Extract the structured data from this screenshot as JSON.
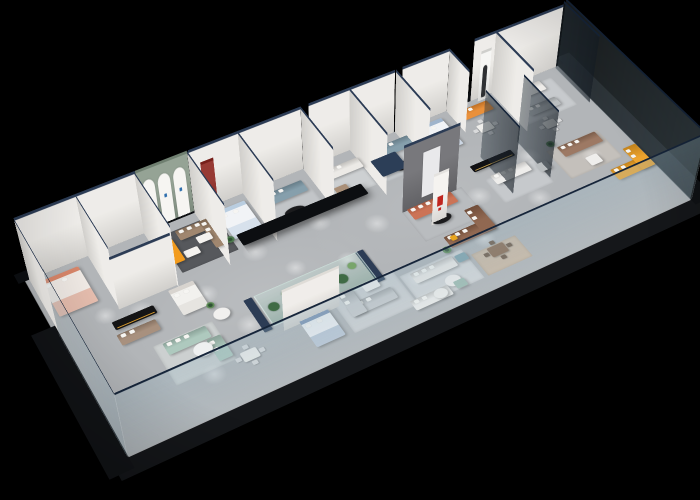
{
  "meta": {
    "background": "#000000"
  },
  "scene": {
    "wallH": 85,
    "glassH": 92,
    "wallColor": "#edebe7",
    "wallCap": "#2c3c55",
    "glassCap": "#16253a",
    "floor": {
      "w": 1150,
      "h": 440,
      "color": "#b2b5b8"
    },
    "aprons": [
      {
        "x": -20,
        "y": 440,
        "w": 1192,
        "h": 36,
        "c": "#15171a"
      },
      {
        "x": -36,
        "y": 128,
        "w": 44,
        "h": 336,
        "c": "#121417"
      },
      {
        "x": 1146,
        "y": -14,
        "w": 44,
        "h": 468,
        "c": "#101215"
      },
      {
        "x": -12,
        "y": -16,
        "w": 1174,
        "h": 24,
        "c": "#0d0f12"
      }
    ],
    "rugs": [
      {
        "x": 250,
        "y": 30,
        "w": 112,
        "h": 100,
        "c": "#56585c"
      },
      {
        "x": 438,
        "y": 32,
        "w": 112,
        "h": 100,
        "c": "#c2c5c8"
      },
      {
        "x": 128,
        "y": 40,
        "w": 100,
        "h": 85,
        "c": "#c7c9cb"
      },
      {
        "x": 664,
        "y": 198,
        "w": 130,
        "h": 85,
        "c": "#b9bcbf"
      },
      {
        "x": 448,
        "y": 310,
        "w": 128,
        "h": 92,
        "c": "#cfd1d3"
      },
      {
        "x": 580,
        "y": 330,
        "w": 130,
        "h": 78,
        "c": "#d4d6d8"
      },
      {
        "x": 718,
        "y": 350,
        "w": 95,
        "h": 58,
        "c": "#cbb9a5"
      },
      {
        "x": 985,
        "y": 200,
        "w": 120,
        "h": 85,
        "c": "#c4c0bb"
      },
      {
        "x": 842,
        "y": 205,
        "w": 110,
        "h": 70,
        "c": "#c6c9cc"
      },
      {
        "x": 135,
        "y": 255,
        "w": 112,
        "h": 95,
        "c": "#ccd0d0"
      },
      {
        "x": 680,
        "y": 30,
        "w": 104,
        "h": 88,
        "c": "#c3c7ca"
      },
      {
        "x": 568,
        "y": 36,
        "w": 92,
        "h": 78,
        "c": "#cdd0d2"
      },
      {
        "x": 996,
        "y": 30,
        "w": 118,
        "h": 92,
        "c": "#c7cacd"
      }
    ],
    "spots": [
      [
        150,
        175,
        24
      ],
      [
        265,
        195,
        22
      ],
      [
        385,
        150,
        24
      ],
      [
        520,
        145,
        22
      ],
      [
        610,
        200,
        24
      ],
      [
        700,
        175,
        22
      ],
      [
        810,
        235,
        24
      ],
      [
        950,
        195,
        22
      ],
      [
        300,
        295,
        24
      ],
      [
        455,
        300,
        22
      ],
      [
        610,
        350,
        24
      ],
      [
        760,
        330,
        22
      ],
      [
        905,
        295,
        24
      ],
      [
        1055,
        255,
        22
      ],
      [
        200,
        360,
        22
      ],
      [
        92,
        152,
        20
      ],
      [
        520,
        250,
        20
      ],
      [
        430,
        220,
        20
      ]
    ],
    "walls": [
      {
        "d": "x",
        "x": 8,
        "y": 8,
        "len": 224
      },
      {
        "d": "x",
        "x": 232,
        "y": 8,
        "len": 100,
        "c": "#8d9c8d",
        "cap": "#6f7f70",
        "arches": 3
      },
      {
        "d": "x",
        "x": 334,
        "y": 8,
        "len": 226
      },
      {
        "d": "x",
        "x": 576,
        "y": 8,
        "len": 184
      },
      {
        "d": "x",
        "x": 776,
        "y": 8,
        "len": 104
      },
      {
        "d": "x",
        "x": 936,
        "y": 8,
        "len": 206
      },
      {
        "d": "y",
        "x": 8,
        "y": 8,
        "len": 134
      },
      {
        "d": "y",
        "x": 120,
        "y": 8,
        "len": 140
      },
      {
        "d": "y",
        "x": 230,
        "y": 8,
        "len": 148
      },
      {
        "d": "y",
        "x": 332,
        "y": 8,
        "len": 148
      },
      {
        "d": "y",
        "x": 432,
        "y": 8,
        "len": 138
      },
      {
        "d": "y",
        "x": 560,
        "y": 8,
        "len": 122
      },
      {
        "d": "y",
        "x": 662,
        "y": 8,
        "len": 138
      },
      {
        "d": "y",
        "x": 762,
        "y": 8,
        "len": 122
      },
      {
        "d": "y",
        "x": 880,
        "y": 8,
        "len": 70
      },
      {
        "d": "y",
        "x": 985,
        "y": 8,
        "len": 128
      },
      {
        "d": "x",
        "x": 118,
        "y": 150,
        "len": 112,
        "h": 72
      },
      {
        "d": "x",
        "x": 664,
        "y": 200,
        "len": 118,
        "h": 92,
        "c": "#6e6e72",
        "panel": "#e9e9eb"
      },
      {
        "d": "x",
        "x": 345,
        "y": 336,
        "len": 110,
        "h": 56,
        "c": "#efece8",
        "cap": "#dfdcd7"
      },
      {
        "d": "x",
        "x": 352,
        "y": 14,
        "len": 26,
        "h": 66,
        "c": "#8f2b25",
        "cap": "#771f1a"
      },
      {
        "d": "x",
        "x": 948,
        "y": 16,
        "len": 24,
        "h": 68,
        "c": "#f5f5f3",
        "cap": "#cfcfcc",
        "figure": true
      },
      {
        "d": "x",
        "x": 694,
        "y": 254,
        "len": 32,
        "h": 70,
        "c": "#f4f2ef",
        "cap": "#e4e2df",
        "mark": "#c0251f"
      }
    ],
    "glass": [
      {
        "d": "y",
        "x": 6,
        "y": 150,
        "len": 288
      },
      {
        "d": "x",
        "x": 6,
        "y": 438,
        "len": 1142
      },
      {
        "d": "y",
        "x": 1146,
        "y": 8,
        "len": 430
      },
      {
        "d": "y",
        "x": 868,
        "y": 150,
        "len": 112,
        "tint": true
      },
      {
        "d": "y",
        "x": 952,
        "y": 150,
        "len": 112,
        "tint": true
      },
      {
        "d": "y",
        "x": 1138,
        "y": 12,
        "len": 118,
        "tint": true
      }
    ],
    "furniture": [
      {
        "type": "bed",
        "x": 20,
        "y": 34,
        "w": 72,
        "h": 92,
        "c": "#efe9e4",
        "accent": "#d8866a"
      },
      {
        "type": "bed",
        "x": 362,
        "y": 38,
        "w": 58,
        "h": 78,
        "c": "#f1f3f6",
        "accent": "#b9cde0"
      },
      {
        "type": "bed",
        "x": 790,
        "y": 32,
        "w": 62,
        "h": 82,
        "c": "#f1f3f6",
        "accent": "#9fb4cc"
      },
      {
        "type": "bed",
        "x": 206,
        "y": 166,
        "w": 48,
        "h": 64,
        "c": "#f2f1ee",
        "accent": "#d8d4cf"
      },
      {
        "type": "bed",
        "x": 372,
        "y": 340,
        "w": 56,
        "h": 66,
        "c": "#eef0f3",
        "accent": "#7e96b5"
      },
      {
        "type": "sofa",
        "x": 138,
        "y": 52,
        "w": 86,
        "h": 30,
        "c": "#d27a55",
        "p": 3
      },
      {
        "type": "sofa",
        "x": 276,
        "y": 44,
        "w": 74,
        "h": 26,
        "c": "#9a7f66",
        "p": 3
      },
      {
        "type": "sofa",
        "x": 324,
        "y": 44,
        "w": 26,
        "h": 74,
        "c": "#9a7f66",
        "p": 2
      },
      {
        "type": "sofa",
        "x": 448,
        "y": 44,
        "w": 88,
        "h": 30,
        "c": "#7e99a7",
        "p": 3
      },
      {
        "type": "sofa",
        "x": 572,
        "y": 44,
        "w": 84,
        "h": 28,
        "c": "#ebe9e5",
        "p": 3
      },
      {
        "type": "sofa",
        "x": 688,
        "y": 40,
        "w": 84,
        "h": 30,
        "c": "#7e99a7",
        "p": 3
      },
      {
        "type": "sofa",
        "x": 888,
        "y": 34,
        "w": 68,
        "h": 28,
        "c": "#e8892e",
        "p": 2
      },
      {
        "type": "sofa",
        "x": 1000,
        "y": 38,
        "w": 78,
        "h": 28,
        "c": "#edebe8",
        "p": 3
      },
      {
        "type": "sofa",
        "x": 1008,
        "y": 92,
        "w": 70,
        "h": 24,
        "c": "#b7bbbd",
        "p": 2
      },
      {
        "type": "sofa",
        "x": 88,
        "y": 212,
        "w": 72,
        "h": 26,
        "c": "#a38a76",
        "p": 2
      },
      {
        "type": "sofa",
        "x": 148,
        "y": 268,
        "w": 80,
        "h": 28,
        "c": "#a9c6ba",
        "p": 3
      },
      {
        "type": "sofa",
        "x": 216,
        "y": 298,
        "w": 26,
        "h": 52,
        "c": "#a9c6ba",
        "p": 2
      },
      {
        "type": "sofa",
        "x": 668,
        "y": 208,
        "w": 94,
        "h": 30,
        "c": "#c96a4b",
        "p": 3
      },
      {
        "type": "sofa",
        "x": 848,
        "y": 212,
        "w": 78,
        "h": 26,
        "c": "#edecea",
        "p": 3
      },
      {
        "type": "sofa",
        "x": 1000,
        "y": 212,
        "w": 88,
        "h": 30,
        "c": "#97715a",
        "p": 3
      },
      {
        "type": "sofa",
        "x": 1052,
        "y": 312,
        "w": 84,
        "h": 30,
        "c": "#f0a122",
        "p": 2
      },
      {
        "type": "sofa",
        "x": 1106,
        "y": 278,
        "w": 30,
        "h": 64,
        "c": "#f0a122",
        "p": 2
      },
      {
        "type": "sofa",
        "x": 458,
        "y": 352,
        "w": 90,
        "h": 28,
        "c": "#c7c9cb",
        "p": 3
      },
      {
        "type": "sofa",
        "x": 458,
        "y": 320,
        "w": 28,
        "h": 60,
        "c": "#c7c9cb",
        "p": 2
      },
      {
        "type": "sofa",
        "x": 592,
        "y": 344,
        "w": 86,
        "h": 26,
        "c": "#ebe9e6",
        "p": 3
      },
      {
        "type": "sofa",
        "x": 690,
        "y": 300,
        "w": 96,
        "h": 30,
        "c": "#8a5f47",
        "p": 3
      },
      {
        "type": "sofa",
        "x": 758,
        "y": 262,
        "w": 30,
        "h": 66,
        "c": "#8a5f47",
        "p": 2
      },
      {
        "type": "sofa",
        "x": 560,
        "y": 398,
        "w": 76,
        "h": 24,
        "c": "#edecea",
        "p": 2
      },
      {
        "type": "chair",
        "x": 578,
        "y": 94,
        "w": 26,
        "h": 24,
        "c": "#a98f78"
      },
      {
        "type": "chair",
        "x": 938,
        "y": 230,
        "w": 24,
        "h": 22,
        "c": "#b9bdbf"
      },
      {
        "type": "chair",
        "x": 1030,
        "y": 262,
        "w": 26,
        "h": 24,
        "c": "#efeeec"
      },
      {
        "type": "table",
        "x": 158,
        "y": 100,
        "w": 40,
        "h": 30,
        "c": "#1d1d1f",
        "circle": true
      },
      {
        "type": "table",
        "x": 268,
        "y": 96,
        "w": 28,
        "h": 18,
        "c": "#f4f2ef"
      },
      {
        "type": "table",
        "x": 302,
        "y": 76,
        "w": 28,
        "h": 18,
        "c": "#f4f2ef"
      },
      {
        "type": "table",
        "x": 468,
        "y": 98,
        "w": 42,
        "h": 24,
        "c": "#1b1b1d",
        "circle": true
      },
      {
        "type": "table",
        "x": 702,
        "y": 96,
        "w": 38,
        "h": 22,
        "c": "#1b1b1d",
        "circle": true
      },
      {
        "type": "table",
        "x": 186,
        "y": 298,
        "w": 34,
        "h": 30,
        "c": "#eef0f0",
        "circle": true
      },
      {
        "type": "table",
        "x": 250,
        "y": 246,
        "w": 30,
        "h": 26,
        "c": "#f1f0ee",
        "circle": true
      },
      {
        "type": "table",
        "x": 692,
        "y": 248,
        "w": 40,
        "h": 22,
        "c": "#1b1b1d",
        "circle": true
      },
      {
        "type": "table",
        "x": 505,
        "y": 322,
        "w": 30,
        "h": 20,
        "c": "#f2f1ef"
      },
      {
        "type": "table",
        "x": 636,
        "y": 382,
        "w": 30,
        "h": 26,
        "c": "#f0efed",
        "circle": true
      },
      {
        "type": "table",
        "x": 604,
        "y": 398,
        "w": 26,
        "h": 22,
        "c": "#f0efed",
        "circle": true
      },
      {
        "type": "console",
        "x": 92,
        "y": 182,
        "w": 78,
        "h": 20,
        "c": "#141415",
        "accent": "#d79b2f"
      },
      {
        "type": "console",
        "x": 828,
        "y": 172,
        "w": 92,
        "h": 18,
        "c": "#101013",
        "accent": "#caa44c"
      },
      {
        "type": "counter",
        "x": 238,
        "y": 58,
        "w": 26,
        "h": 58,
        "c": "#f29b1d"
      },
      {
        "type": "dining",
        "x": 898,
        "y": 86,
        "w": 30,
        "h": 22,
        "c": "#f0efec",
        "cc": "#d9dadb"
      },
      {
        "type": "dining",
        "x": 742,
        "y": 362,
        "w": 34,
        "h": 24,
        "c": "#8a6b52",
        "cc": "#6f5a48"
      },
      {
        "type": "dining",
        "x": 252,
        "y": 352,
        "w": 30,
        "h": 22,
        "c": "#f0efec",
        "cc": "#d9dadb"
      },
      {
        "type": "dining",
        "x": 1014,
        "y": 142,
        "w": 26,
        "h": 20,
        "c": "#efefec",
        "cc": "#d9dadb"
      },
      {
        "type": "plant",
        "x": 352,
        "y": 118,
        "r": 8,
        "c": "#4e7a4e"
      },
      {
        "type": "plant",
        "x": 990,
        "y": 204,
        "r": 8,
        "c": "#4e7a4e"
      },
      {
        "type": "plant",
        "x": 676,
        "y": 334,
        "r": 8,
        "c": "#5b8a53"
      },
      {
        "type": "plant",
        "x": 254,
        "y": 238,
        "r": 7,
        "c": "#5b8a53"
      },
      {
        "type": "ottoman",
        "x": 682,
        "y": 348,
        "w": 22,
        "h": 18,
        "c": "#7fa3ad"
      },
      {
        "type": "ottoman",
        "x": 648,
        "y": 398,
        "w": 22,
        "h": 18,
        "c": "#9fbcb2"
      },
      {
        "type": "ottoman",
        "x": 700,
        "y": 304,
        "w": 12,
        "h": 12,
        "c": "#e8a51f"
      },
      {
        "type": "disc",
        "x": 630,
        "y": 140,
        "w": 52,
        "h": 46,
        "c": "#2c3e57",
        "z": 55
      },
      {
        "type": "slab",
        "x": 315,
        "y": 236,
        "w": 240,
        "h": 28,
        "c": "#0c0e11",
        "z": 92
      },
      {
        "type": "terrarium",
        "x": 332,
        "y": 246,
        "w": 205,
        "h": 74,
        "cap": "#2c3c55",
        "glass": "#bfe0d2",
        "plantColors": [
          "#3f6b45",
          "#5b8a53",
          "#4e7a4e",
          "#6b9a60",
          "#3f6b45",
          "#78a56b"
        ],
        "plants": [
          [
            20,
            40,
            10
          ],
          [
            52,
            24,
            8
          ],
          [
            86,
            46,
            12
          ],
          [
            120,
            30,
            9
          ],
          [
            154,
            44,
            11
          ],
          [
            184,
            26,
            8
          ]
        ]
      }
    ]
  }
}
